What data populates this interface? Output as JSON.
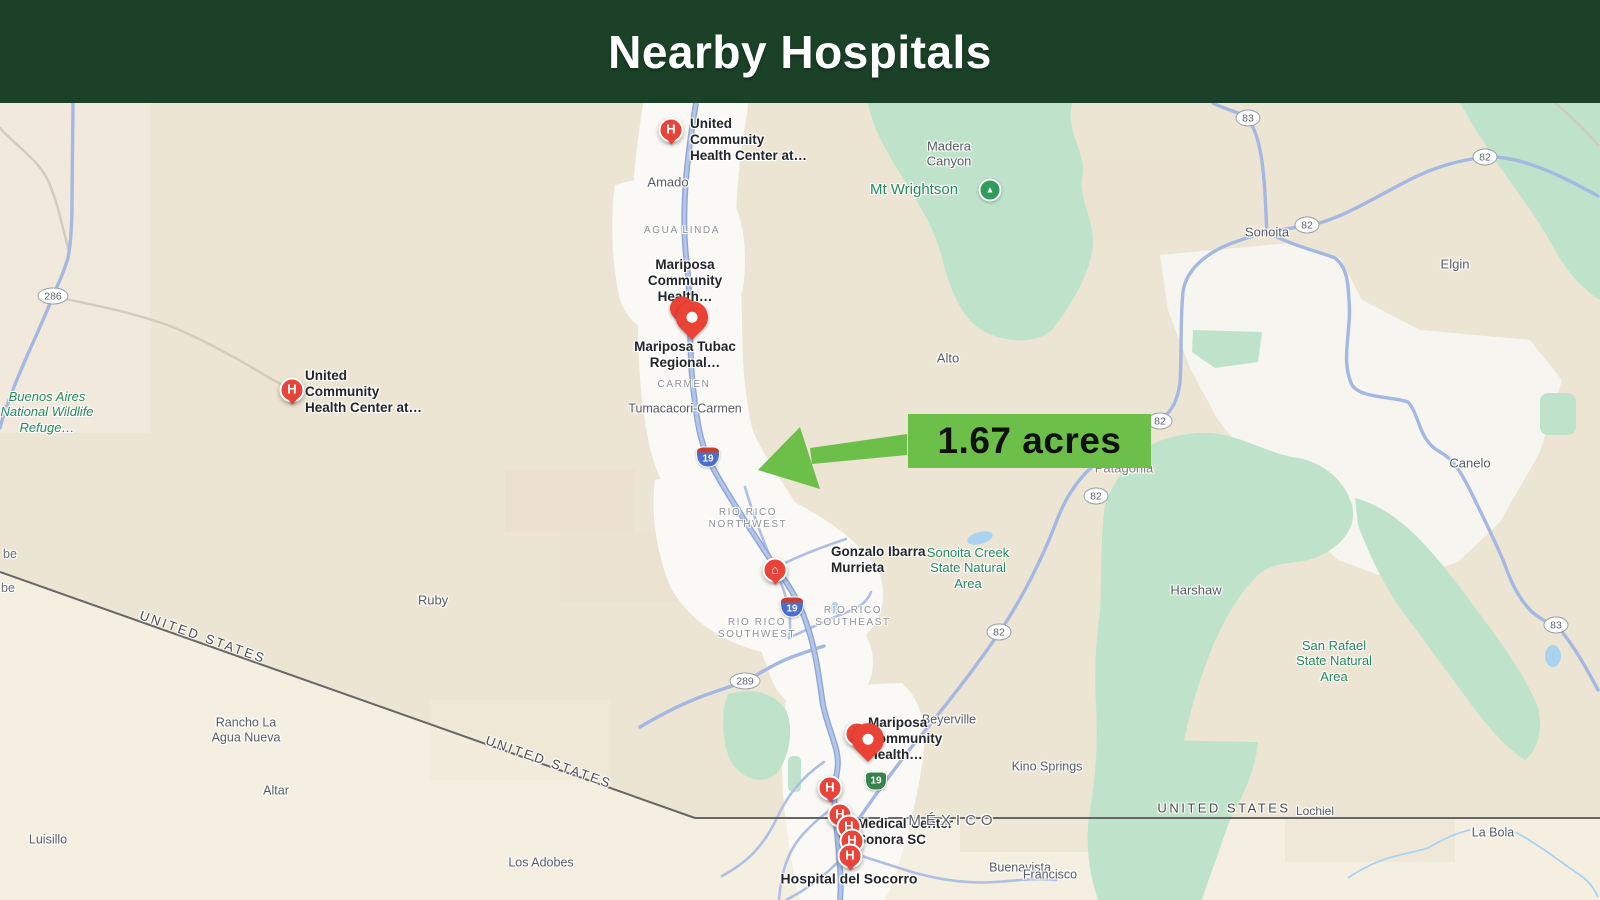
{
  "header": {
    "title": "Nearby Hospitals"
  },
  "callout": {
    "label": "1.67 acres",
    "color": "#6CC04A"
  },
  "map": {
    "towns": [
      "Amado",
      "Madera Canyon",
      "Alto",
      "Sonoita",
      "Elgin",
      "Canelo",
      "Harshaw",
      "Patagonia",
      "Ruby",
      "Tumacacori-Carmen",
      "Rancho La Agua Nueva",
      "Altar",
      "Luisillo",
      "Los Adobes",
      "Beyerville",
      "Kino Springs",
      "Buenavista",
      "Lochiel",
      "La Bola",
      "Francisco"
    ],
    "neighborhoods": [
      "AGUA LINDA",
      "CARMEN",
      "RIO RICO NORTHWEST",
      "RIO RICO SOUTHWEST",
      "RIO RICO SOUTHEAST"
    ],
    "natural_areas": [
      "Buenos Aires National Wildlife Refuge…",
      "Mt Wrightson",
      "Sonoita Creek State Natural Area",
      "San Rafael State Natural Area"
    ],
    "pois": [
      "United Community Health Center at…",
      "United Community Health Center at…",
      "Mariposa Community Health…",
      "Mariposa Tubac Regional…",
      "Gonzalo Ibarra Murrieta",
      "Mariposa Community Health…",
      "Medical Center Sonora SC",
      "Hospital del Socorro"
    ],
    "border_labels": {
      "us": "UNITED STATES",
      "mx": "MÉXICO"
    },
    "shields": {
      "s19": "19",
      "s82": "82",
      "s83": "83",
      "s286": "286",
      "s289": "289"
    },
    "icons": {
      "hospital_glyph": "H",
      "building_glyph": "⌂",
      "mountain_glyph": "▲"
    },
    "edge_fragments": {
      "f0": "be",
      "f1": "be",
      "ranch": "SAN ME RANCH"
    },
    "colors": {
      "park_green": "#BFE3CA",
      "highway_blue": "#9AB1E0",
      "border_gray": "#666666",
      "marker_red": "#E8443A"
    }
  }
}
